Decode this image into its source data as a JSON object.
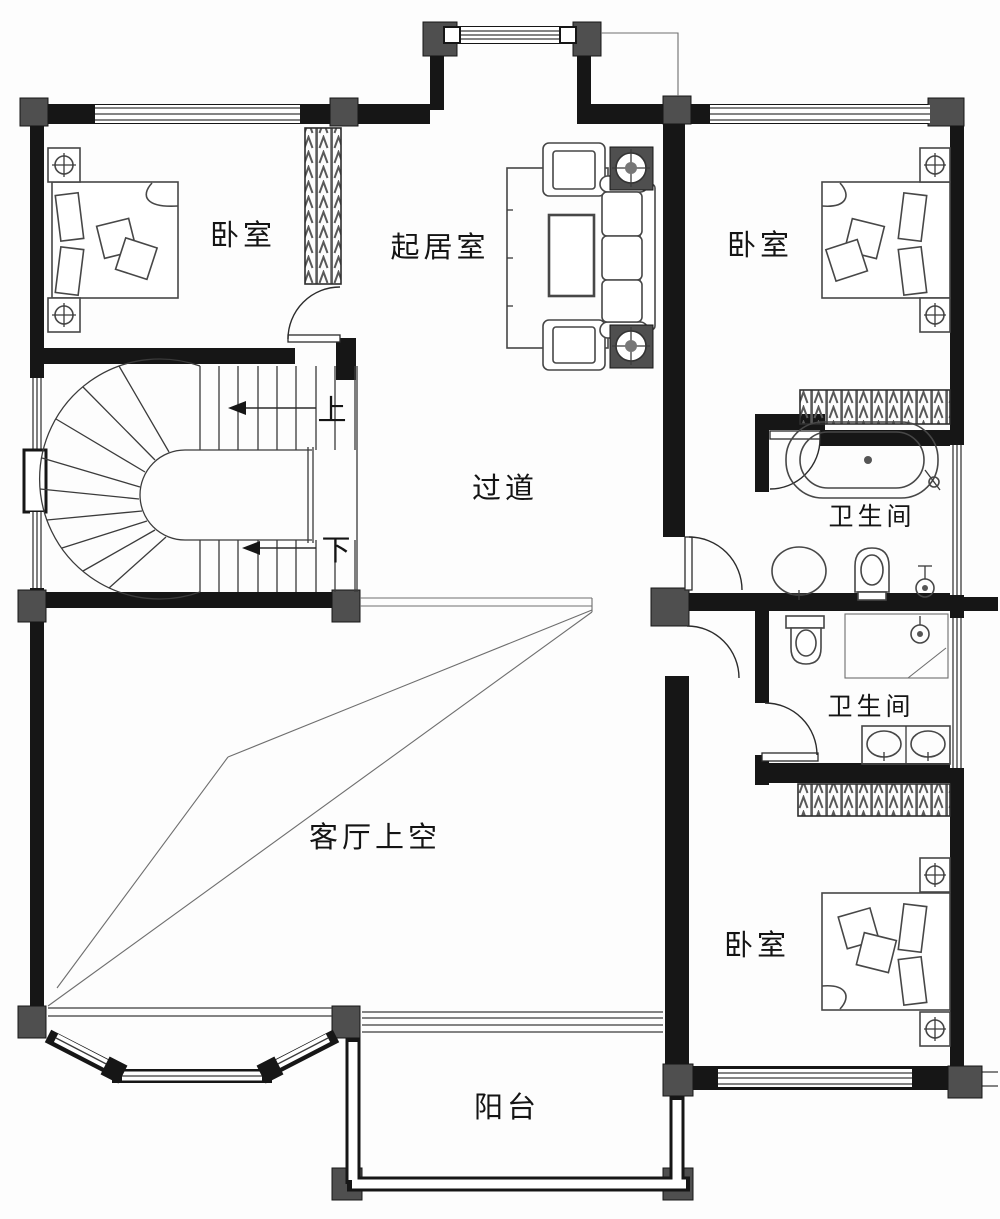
{
  "plan": {
    "type": "floor-plan",
    "labels": {
      "bedroom_top_left": "卧室",
      "living_room": "起居室",
      "bedroom_top_right": "卧室",
      "corridor": "过道",
      "bathroom_top": "卫生间",
      "bathroom_bottom": "卫生间",
      "void_above_living": "客厅上空",
      "bedroom_bottom_right": "卧室",
      "balcony": "阳台",
      "stairs_up": "上",
      "stairs_down": "下"
    },
    "colors": {
      "wall": "#161616",
      "column": "#4f4f4f",
      "thin_line": "#3b3b3b",
      "background": "#ffffff"
    }
  }
}
